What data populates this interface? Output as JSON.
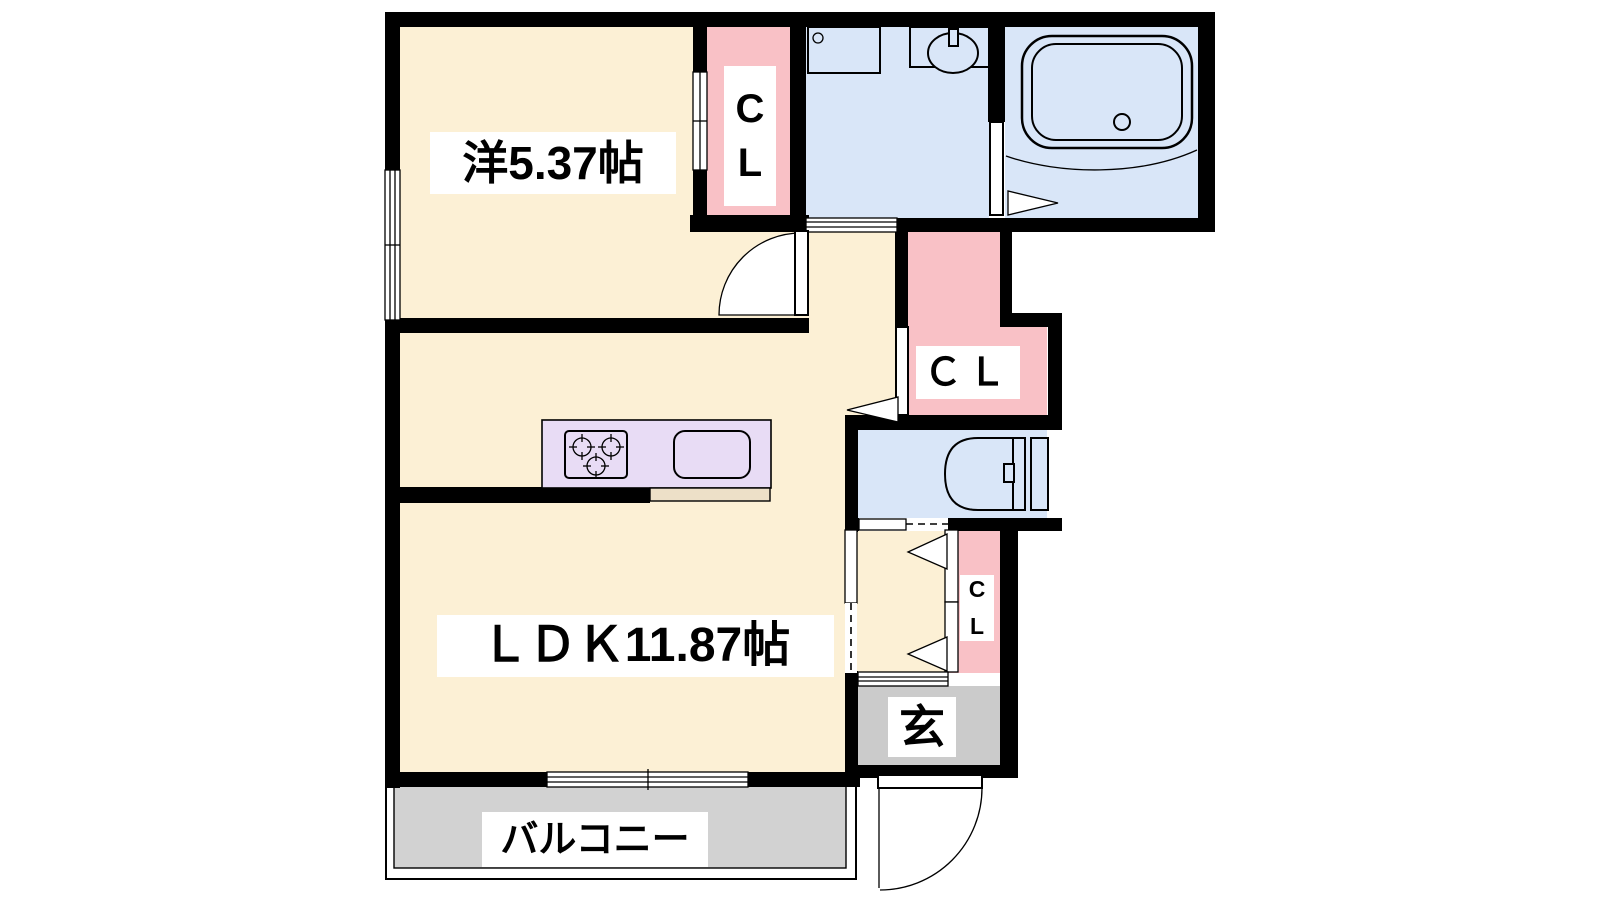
{
  "page": {
    "title": "1LDK apartment floor plan"
  },
  "palette": {
    "wall": "#000000",
    "room_cream": "#FCF0D5",
    "closet_pink": "#F9C1C6",
    "wet_blue": "#D9E6F8",
    "kitchen_lavender": "#E8DCF5",
    "counter_tan": "#EDE0C8",
    "entrance_gray": "#CBCBCB",
    "balcony_gray": "#D2D2D2",
    "label_bg": "#FFFFFF",
    "label_text": "#000000"
  },
  "rooms": {
    "bedroom": {
      "label": "洋5.37帖",
      "type": "western-style room",
      "size_jo": 5.37
    },
    "ldk": {
      "label": "ＬＤＫ11.87帖",
      "type": "living-dining-kitchen",
      "size_jo": 11.87
    },
    "closet_top": {
      "label_lines": [
        "C",
        "L"
      ],
      "type": "closet"
    },
    "closet_middle": {
      "label": "ＣＬ",
      "type": "closet"
    },
    "closet_small": {
      "label_lines": [
        "C",
        "L"
      ],
      "type": "closet"
    },
    "entrance": {
      "label": "玄",
      "type": "entrance (genkan)"
    },
    "balcony": {
      "label": "バルコニー",
      "type": "balcony"
    },
    "washroom": {
      "type": "washroom / laundry"
    },
    "bathroom": {
      "type": "bathroom"
    },
    "toilet": {
      "type": "toilet"
    }
  },
  "fixtures": [
    "bathtub",
    "wash-basin",
    "washing-machine-pan",
    "toilet-bowl",
    "gas-stove-3-burners",
    "kitchen-sink",
    "kitchen-counter",
    "entrance-door-swing-arc",
    "bedroom-door-swing-arc",
    "sliding-window-balcony",
    "bedroom-window",
    "sliding-doors",
    "folding-door-markers"
  ]
}
